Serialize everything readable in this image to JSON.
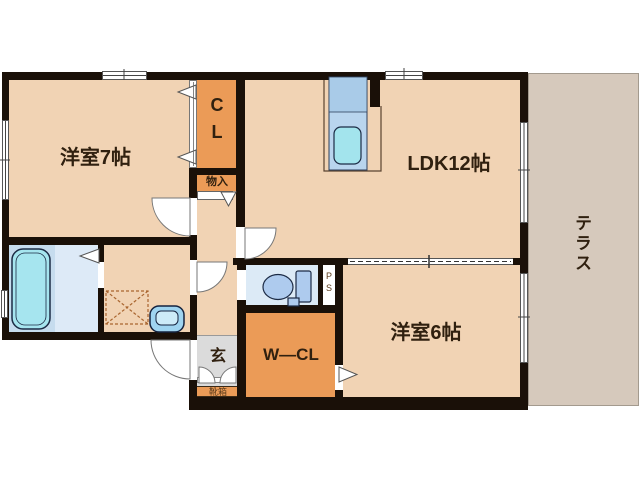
{
  "plan": {
    "type": "japanese-apartment-floor-plan",
    "labels": {
      "room7": "洋室7帖",
      "ldk": "LDK12帖",
      "room6": "洋室6帖",
      "terrace": "テラス",
      "closet": "CL",
      "storage": "物入",
      "walk_in_closet": "W—CL",
      "entrance_hall": "玄",
      "shoe_cabinet": "靴箱",
      "pipe_space": "PS"
    },
    "colors": {
      "wall": "#1A1008",
      "room_floor": "#F1D3B4",
      "closet_orange": "#EB9B57",
      "terrace": "#D6C9BC",
      "bath_floor": "#C6DCEE",
      "washroom_bath_zone": "#DDEAF7",
      "toilet_floor": "#DCEAF6",
      "water_fixture": "#A6E5EF",
      "kitchen_unit": "#B9D5EE",
      "entrance_floor": "#DBDBDB",
      "label_text": "#30200F"
    }
  }
}
